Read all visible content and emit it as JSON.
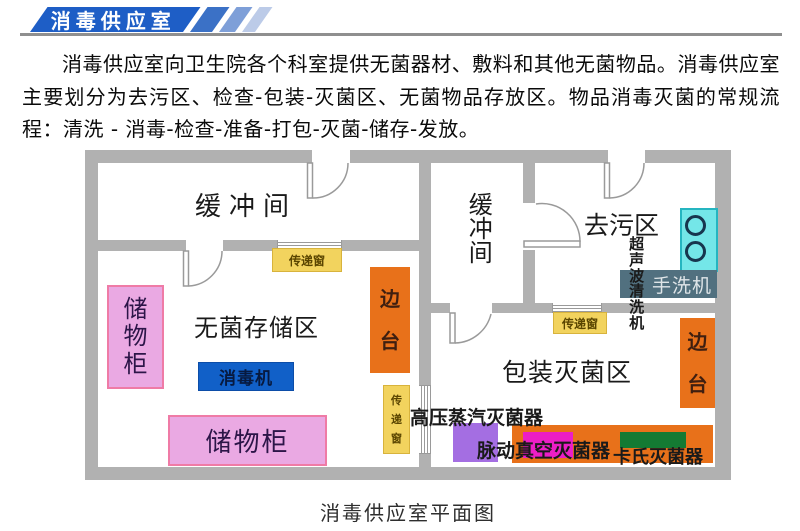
{
  "header": {
    "banner_title": "消毒供应室"
  },
  "intro": {
    "text": "消毒供应室向卫生院各个科室提供无菌器材、敷料和其他无菌物品。消毒供应室主要划分为去污区、检查-包装-灭菌区、无菌物品存放区。物品消毒灭菌的常规流程：清洗 - 消毒-检查-准备-打包-灭菌-储存-发放。"
  },
  "floorplan": {
    "rooms": {
      "buffer_left": "缓冲间",
      "sterile_storage": "无菌存储区",
      "buffer_right": "缓冲间",
      "decontamination": "去污区",
      "packaging": "包装灭菌区"
    },
    "equipment": {
      "cabinet_left": "储物柜",
      "cabinet_bottom": "储物柜",
      "disinfector": "消毒机",
      "side_table_left": "边台",
      "side_table_right": "边台",
      "transfer_window_top": "传递窗",
      "transfer_window_mid": "传递窗",
      "transfer_window_right": "传递窗",
      "ultrasonic_cleaner": "超声波清洗机",
      "hand_washer": "手洗机",
      "autoclave": "高压蒸汽灭菌器",
      "pulse_vacuum_sterilizer": "脉动真空灭菌器",
      "cassette_sterilizer": "卡氏灭菌器"
    },
    "caption": "消毒供应室平面图"
  },
  "colors": {
    "banner_blue": "#1e5ec6",
    "stripe_blues": [
      "#3b71c6",
      "#7e9fd8",
      "#bccbe8"
    ],
    "wall_gray": "#b1b1b1",
    "transfer_window_yellow": "#f2d35e",
    "cabinet_pink": "#eaa9e3",
    "side_table_orange": "#e8711a",
    "disinfector_blue": "#1160c8",
    "sink_cyan": "#74e6e8",
    "hand_washer_slate": "#51707f",
    "autoclave_purple": "#a46ee2",
    "pulse_magenta": "#ec1ec6",
    "cassette_green": "#147a33"
  }
}
